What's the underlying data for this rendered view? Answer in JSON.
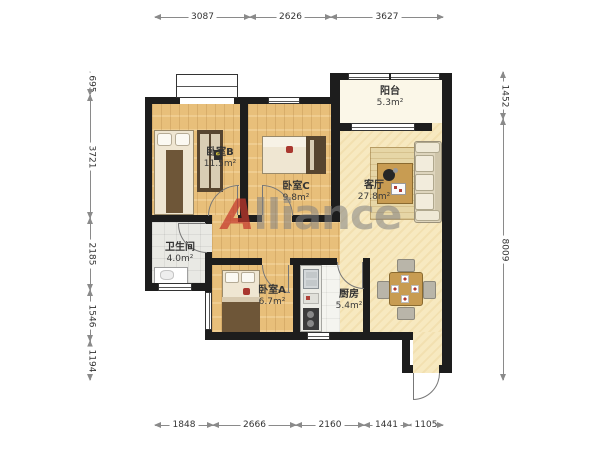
{
  "floorplan": {
    "watermark": {
      "logo_letter": "A",
      "brand_rest": "lliance"
    },
    "rooms": {
      "balcony": {
        "name": "阳台",
        "area": "5.3m²"
      },
      "bedroom_b": {
        "name": "卧室B",
        "area": "11.5m²"
      },
      "bedroom_c": {
        "name": "卧室C",
        "area": "9.8m²"
      },
      "living": {
        "name": "客厅",
        "area": "27.8m²"
      },
      "bathroom": {
        "name": "卫生间",
        "area": "4.0m²"
      },
      "bedroom_a": {
        "name": "卧室A",
        "area": "6.7m²"
      },
      "kitchen": {
        "name": "厨房",
        "area": "5.4m²"
      }
    },
    "dimensions_mm": {
      "top": [
        "3087",
        "2626",
        "3627"
      ],
      "bottom": [
        "1848",
        "2666",
        "2160",
        "1441",
        "1105"
      ],
      "left": [
        "695",
        "3721",
        "2185",
        "1546",
        "1194"
      ],
      "right": [
        "1452",
        "8009"
      ]
    }
  }
}
